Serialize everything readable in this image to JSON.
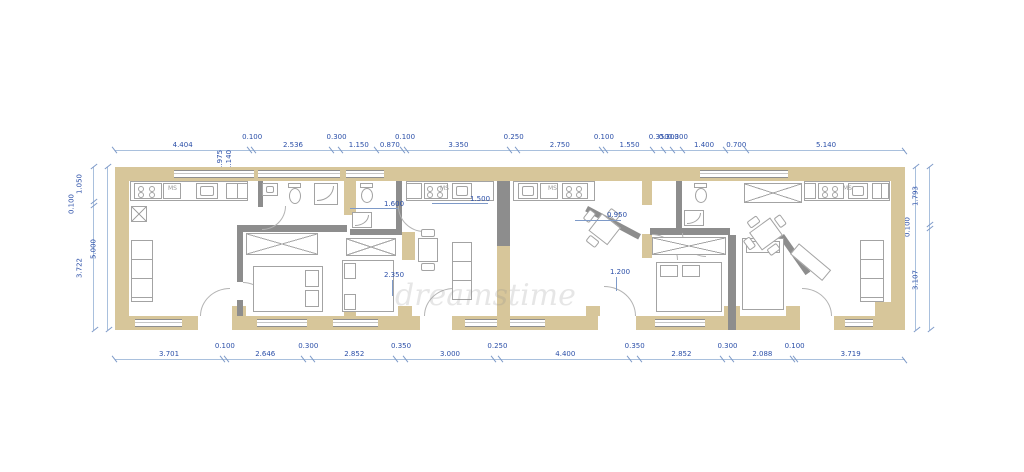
{
  "watermark": "dreamstime",
  "dimensions": {
    "top": [
      "4.404",
      "0.100",
      "2.536",
      "0.300",
      "1.150",
      "0.870",
      "0.100",
      "3.350",
      "0.250",
      "2.750",
      "0.100",
      "1.550",
      "0.350",
      "0.300",
      "0.300",
      "1.400",
      "0.700",
      "5.140"
    ],
    "top_rotated": [
      "1.975",
      "1.140"
    ],
    "bottom": [
      "3.701",
      "0.100",
      "2.646",
      "0.300",
      "2.852",
      "0.350",
      "3.000",
      "0.250",
      "4.400",
      "0.350",
      "2.852",
      "0.300",
      "2.088",
      "0.100",
      "3.719"
    ],
    "left_outer": [
      "1.050",
      "0.100",
      "3.722"
    ],
    "left_total": [
      "5.000"
    ],
    "right_total": [
      "5.000"
    ],
    "right_outer": [
      "1.793",
      "0.100",
      "3.107"
    ]
  },
  "room_labels": {
    "bath2": "1.600",
    "kitchen2": "1.500",
    "bed2": "2.350",
    "dining3": "0.950",
    "bed3": "1.200"
  },
  "appliance_labels": {
    "ms1": "MS",
    "ms2": "MS",
    "ms3": "MS",
    "ms4": "MS"
  }
}
